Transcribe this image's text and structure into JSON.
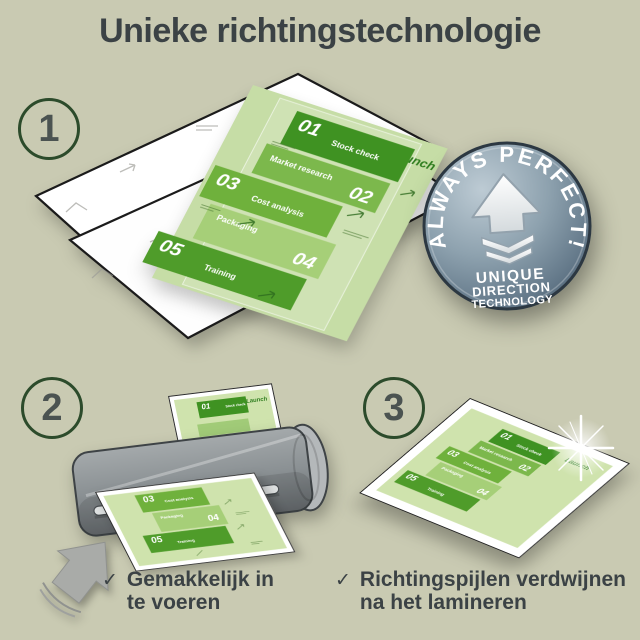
{
  "title": "Unieke richtingstechnologie",
  "steps": [
    {
      "number": "1"
    },
    {
      "number": "2"
    },
    {
      "number": "3"
    }
  ],
  "badge": {
    "arc_text": "ALWAYS PERFECT!",
    "line1": "UNIQUE",
    "line2": "DIRECTION",
    "line3": "TECHNOLOGY"
  },
  "document": {
    "launch_label": "Launch",
    "items": [
      {
        "number": "01",
        "label": "Stock check"
      },
      {
        "number": "02",
        "label": "Market research"
      },
      {
        "number": "03",
        "label": "Cost analysis"
      },
      {
        "number": "04",
        "label": "Packaging"
      },
      {
        "number": "05",
        "label": "Training"
      }
    ]
  },
  "checklist": [
    {
      "line1": "Gemakkelijk in",
      "line2": "te voeren"
    },
    {
      "line1": "Richtingspijlen verdwijnen",
      "line2": "na het lamineren"
    }
  ],
  "colors": {
    "background": "#c9cab2",
    "green_dark": "#3f9222",
    "green_mid": "#6fb13c",
    "green_light": "#a6cf78",
    "paper_green": "#c6dda6",
    "badge_gray_blue": "#64798a",
    "text_dark": "#3b4245"
  }
}
